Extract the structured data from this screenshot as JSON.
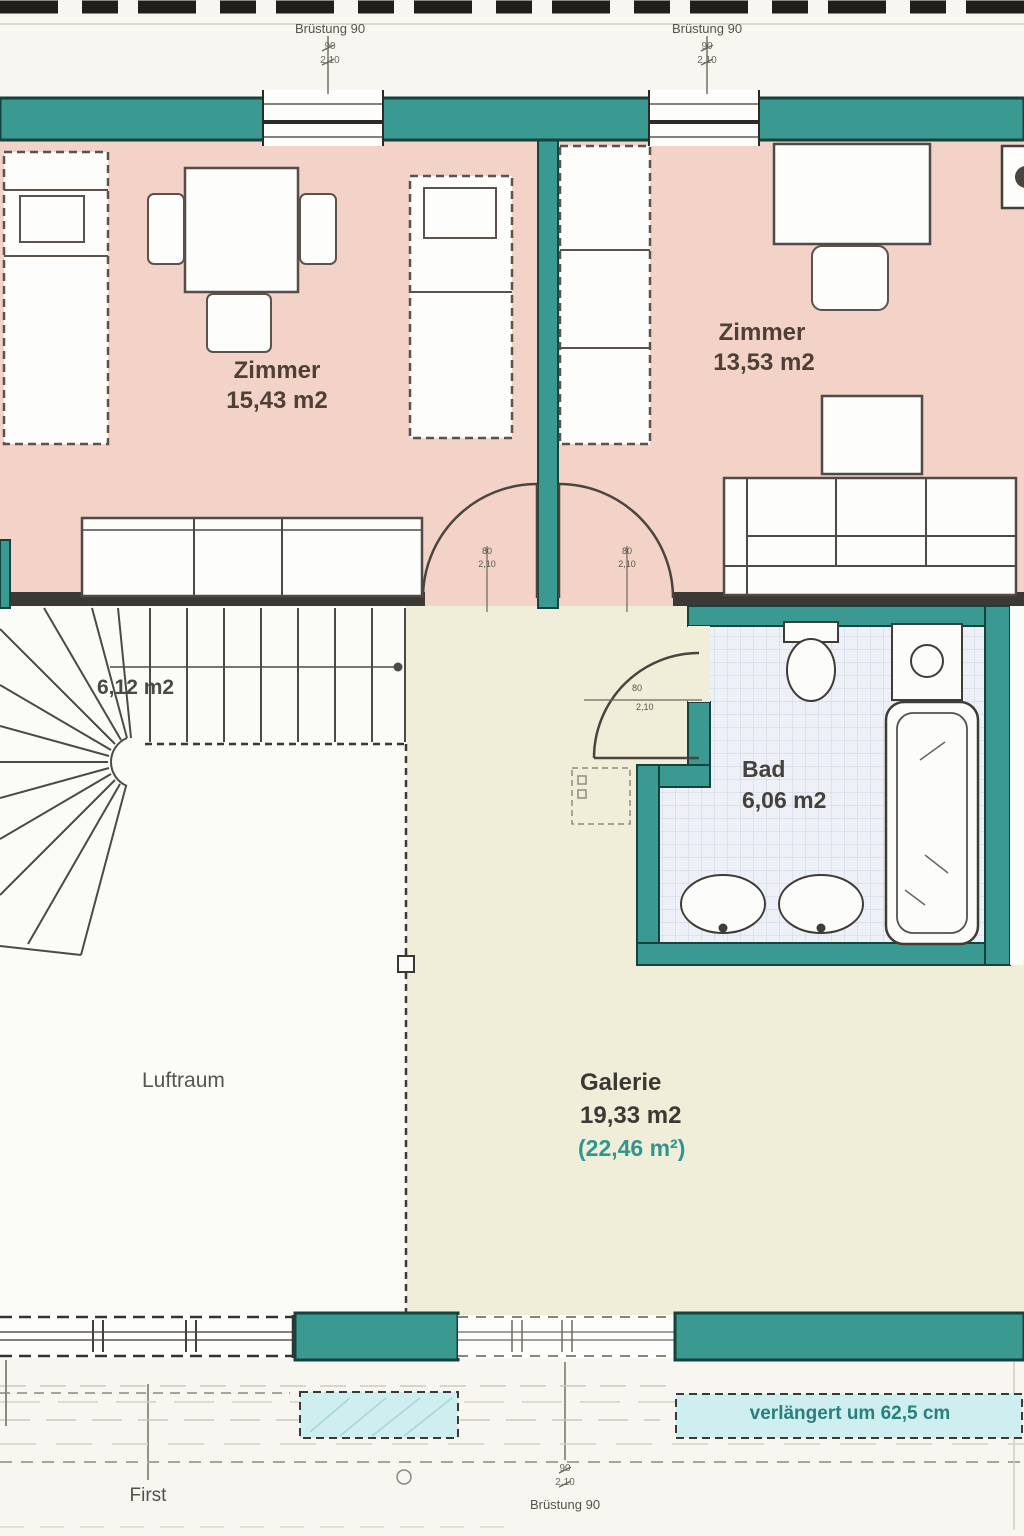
{
  "rooms": {
    "zimmer_left": {
      "name": "Zimmer",
      "area": "15,43 m2"
    },
    "zimmer_right": {
      "name": "Zimmer",
      "area": "13,53 m2"
    },
    "bad": {
      "name": "Bad",
      "area": "6,06 m2"
    },
    "galerie": {
      "name": "Galerie",
      "area": "19,33 m2",
      "area_gross": "(22,46 m²)"
    },
    "stairs": {
      "area": "6,12 m2"
    },
    "luftraum": {
      "name": "Luftraum"
    }
  },
  "annotations": {
    "window_top_left": {
      "label": "Brüstung 90",
      "width": "90",
      "height": "2,10"
    },
    "window_top_right": {
      "label": "Brüstung 90",
      "width": "90",
      "height": "2,10"
    },
    "window_bottom": {
      "label": "Brüstung 90",
      "width": "90",
      "height": "2,10"
    },
    "ridge": {
      "label": "First"
    },
    "extension": {
      "label": "verlängert um 62,5 cm"
    },
    "door_left": {
      "width": "80",
      "height": "2,10"
    },
    "door_right": {
      "width": "80",
      "height": "2,10"
    },
    "door_bad": {
      "width": "80",
      "height": "2,10"
    }
  },
  "colors": {
    "wall_teal": "#3a9a92",
    "wall_teal_edge": "#16423e",
    "room_pink": "#f3d2c7",
    "galerie_yellow": "#f0edd8",
    "bath_tile": "#edf0f6",
    "extension_blue": "#cfeef0",
    "teal_text": "#27807b",
    "ink_dark": "#3b3835"
  }
}
